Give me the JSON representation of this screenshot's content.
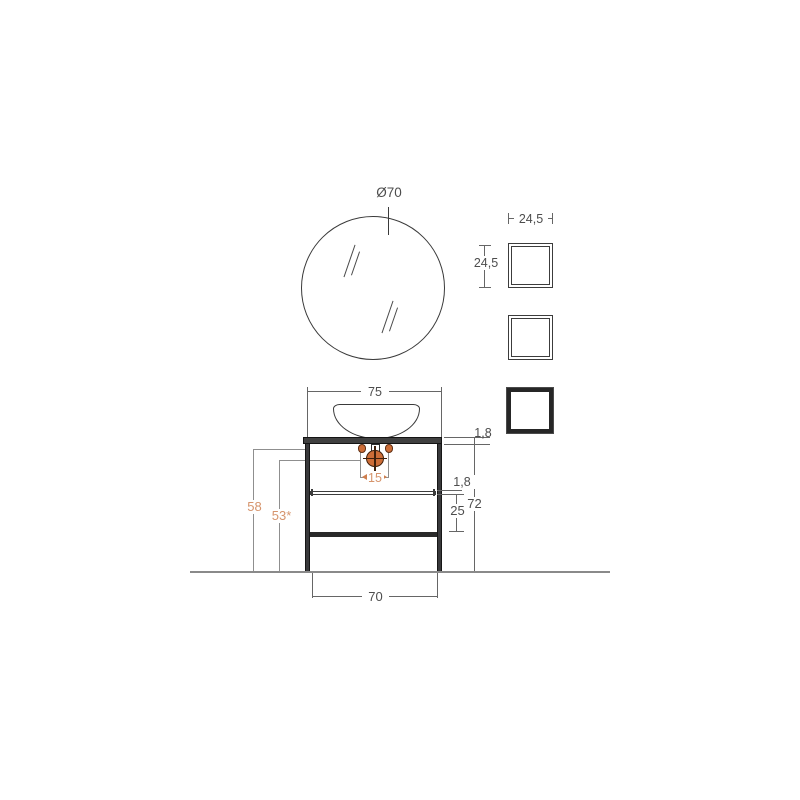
{
  "drawing": {
    "title": "vanity-technical-drawing",
    "colors": {
      "structure_dark": "#3a3a3a",
      "dimension_gray": "#8f8f8f",
      "dimension_text": "#4d4d4d",
      "accent_orange_fill": "#cd6d37",
      "accent_orange_text": "#d6946c",
      "floor_gray": "#8a8a8a"
    },
    "mirror": {
      "diameter_label": "Ø70"
    },
    "wall_boxes": {
      "width_label": "24,5",
      "height_label": "24,5"
    },
    "vanity": {
      "top_width_label": "75",
      "top_thickness_label": "1,8",
      "shelf_thickness_label": "1,8",
      "shelf_to_base_label": "25",
      "total_height_label": "72",
      "holes_height_label": "58",
      "drain_height_label": "53*",
      "holes_spacing_label": "15",
      "base_width_label": "70"
    }
  }
}
